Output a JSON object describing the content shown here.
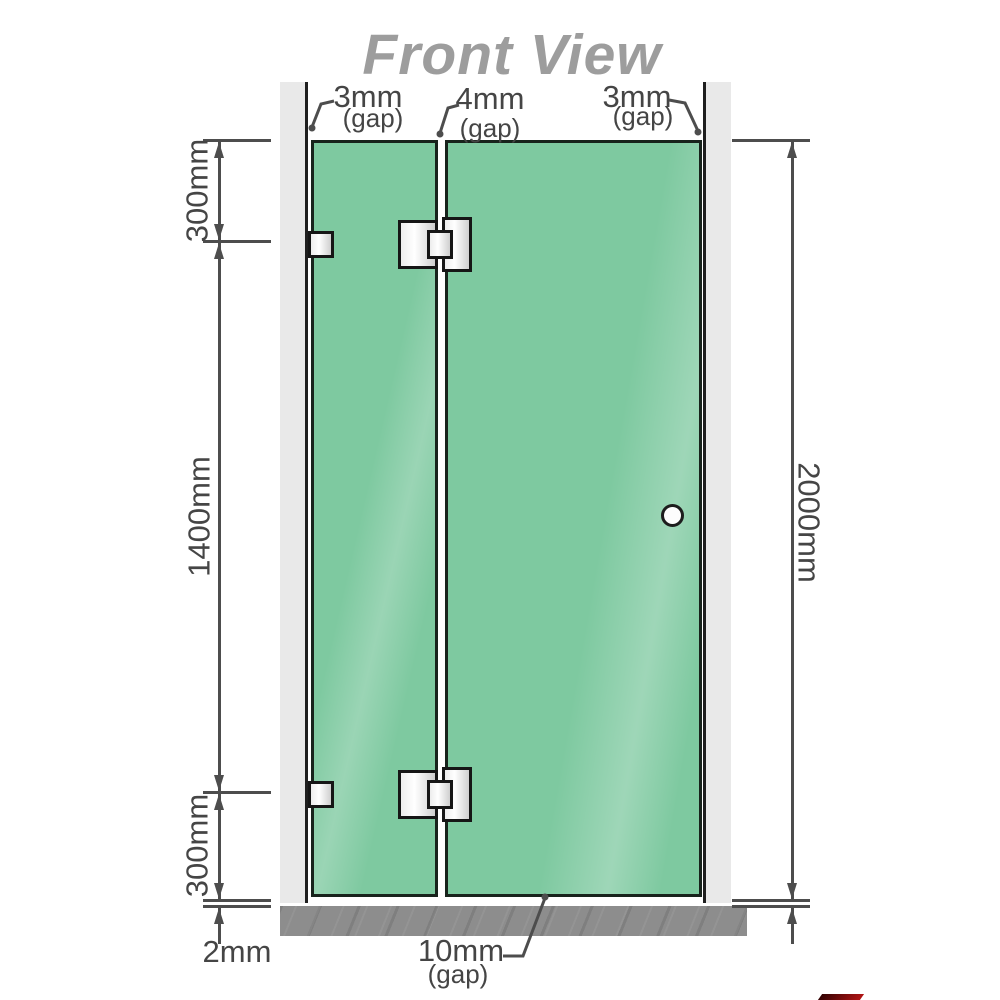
{
  "title": "Front View",
  "top_dimensions": [
    {
      "value": "3mm",
      "note": "(gap)"
    },
    {
      "value": "4mm",
      "note": "(gap)"
    },
    {
      "value": "3mm",
      "note": "(gap)"
    }
  ],
  "left_dimensions": [
    "300mm",
    "1400mm",
    "300mm"
  ],
  "bottom_left_dimension": "2mm",
  "right_dimension": "2000mm",
  "bottom_dimension": {
    "value": "10mm",
    "note": "(gap)"
  },
  "colors": {
    "glass_green": "#7ec9a0",
    "wall_gray": "#e9e9e9",
    "floor_gray": "#8d8d8d",
    "dimension_gray": "#4d4d4d",
    "title_gray": "#9d9d9d",
    "logo_red": "#b11414"
  }
}
